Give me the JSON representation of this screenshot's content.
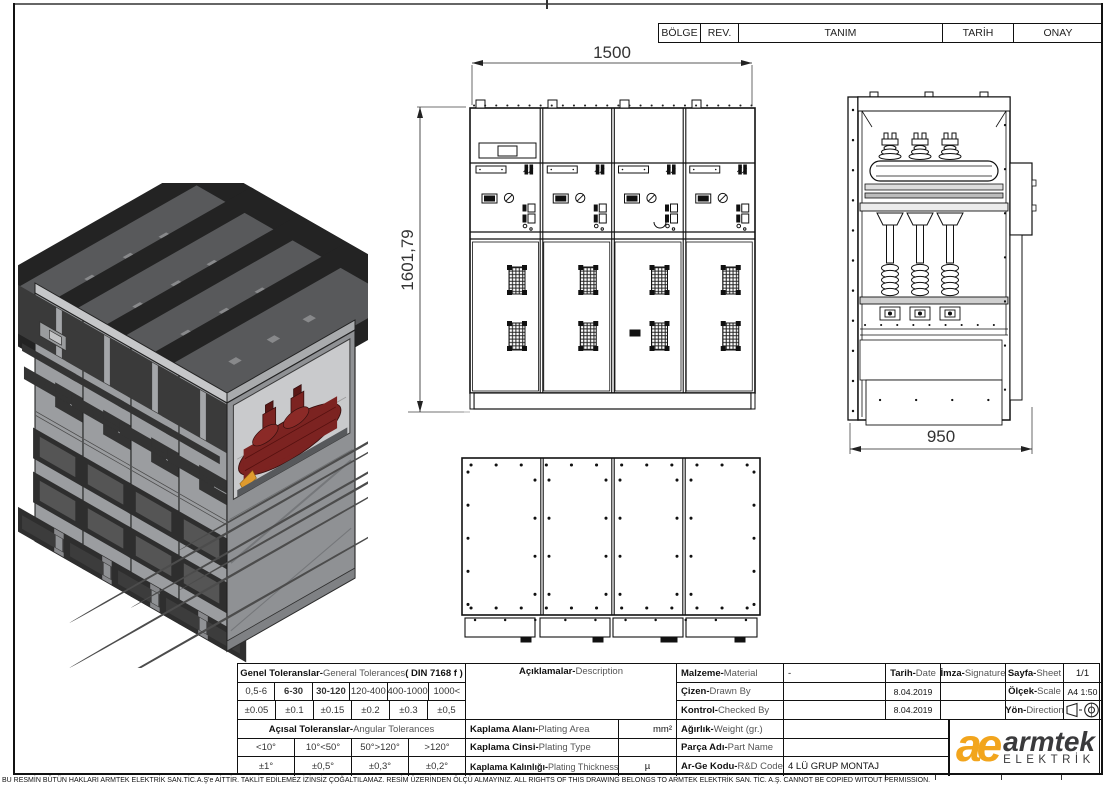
{
  "revision_header": {
    "cols": [
      "BÖLGE",
      "REV.",
      "TANIM",
      "TARİH",
      "ONAY"
    ]
  },
  "dimensions": {
    "front_width": "1500",
    "front_height": "1601,79",
    "side_depth": "950"
  },
  "tolerances": {
    "general": {
      "title_tr": "Genel Toleranslar-",
      "title_en": "General Tolerances ",
      "title_din": "( DIN 7168 f )",
      "ranges": [
        "0,5-6",
        "6-30",
        "30-120",
        "120-400",
        "400-1000",
        "1000<"
      ],
      "values": [
        "±0.05",
        "±0.1",
        "±0.15",
        "±0.2",
        "±0.3",
        "±0,5"
      ]
    },
    "angular": {
      "title_tr": "Açısal Toleranslar-",
      "title_en": "Angular Tolerances",
      "ranges": [
        "<10°",
        "10°<50°",
        "50°>120°",
        ">120°"
      ],
      "values": [
        "±1°",
        "±0,5°",
        "±0,3°",
        "±0,2°"
      ]
    }
  },
  "description": {
    "label_tr": "Açıklamalar-",
    "label_en": "Description"
  },
  "plating": {
    "area_tr": "Kaplama Alanı-",
    "area_en": "Plating Area",
    "area_unit": "mm²",
    "type_tr": "Kaplama Cinsi-",
    "type_en": "Plating Type",
    "type_value": "",
    "thick_tr": "Kaplama Kalınlığı-",
    "thick_en": "Plating Thickness",
    "thick_unit": "µ"
  },
  "info": {
    "malzeme_tr": "Malzeme-",
    "malzeme_en": "Material",
    "malzeme_value": "-",
    "tarih_tr": "Tarih-",
    "tarih_en": "Date",
    "imza_tr": "İmza-",
    "imza_en": "Signature",
    "sayfa_tr": "Sayfa-",
    "sayfa_en": "Sheet",
    "sayfa_value": "1/1",
    "cizen_tr": "Çizen-",
    "cizen_en": "Drawn By",
    "cizen_date": "8.04.2019",
    "olcek_tr": "Ölçek-",
    "olcek_en": "Scale",
    "olcek_value": "A4 1:50",
    "kontrol_tr": "Kontrol-",
    "kontrol_en": "Checked By",
    "kontrol_date": "8.04.2019",
    "yon_tr": "Yön-",
    "yon_en": "Direction",
    "agirlik_tr": "Ağırlık-",
    "agirlik_en": " Weight  (gr.)",
    "agirlik_value": "",
    "parca_tr": "Parça Adı-",
    "parca_en": "Part Name",
    "parca_value": "",
    "arge_tr": "Ar-Ge Kodu-",
    "arge_en": "R&D Code",
    "arge_value": "4 LÜ GRUP MONTAJ"
  },
  "logo": {
    "mark": "ae",
    "name": "armtek",
    "sub": "ELEKTRİK",
    "orange": "#F2A51D",
    "dark": "#3a3a3c"
  },
  "footer": {
    "copyright": "BU RESMİN BÜTÜN HAKLARI ARMTEK ELEKTRİK SAN.TİC.A.Ş'e AİTTİR. TAKLİT EDİLEMEZ İZİNSİZ ÇOĞALTILAMAZ. RESİM ÜZERİNDEN ÖLÇÜ ALMAYINIZ. ALL RIGHTS OF THIS DRAWING BELONGS TO ARMTEK ELEKTRİK SAN. TİC. A.Ş. CANNOT BE COPIED WITOUT PERMISSION."
  }
}
